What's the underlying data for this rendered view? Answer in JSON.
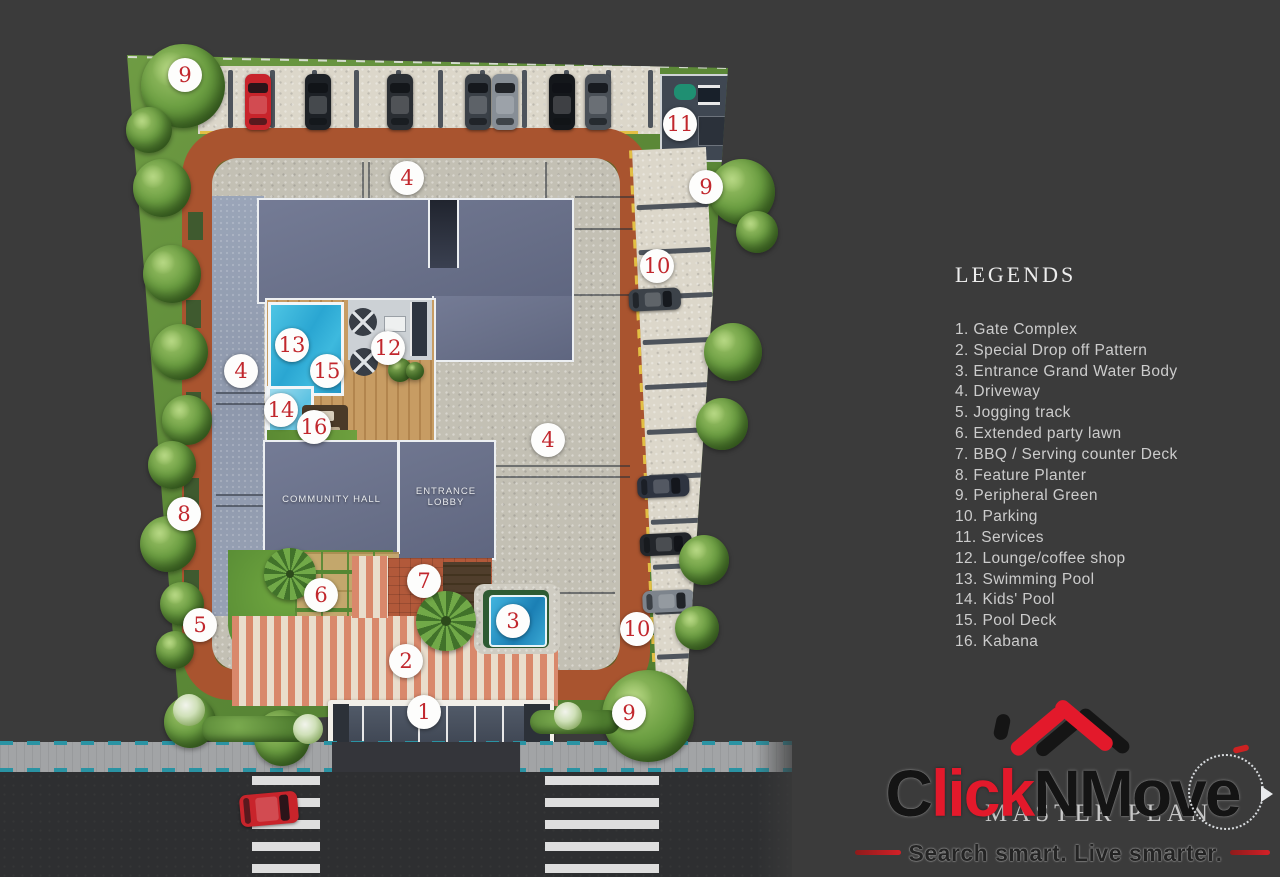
{
  "legend": {
    "title": "LEGENDS",
    "items": [
      "1. Gate Complex",
      "2. Special Drop off Pattern",
      "3. Entrance Grand Water Body",
      "4. Driveway",
      "5. Jogging track",
      "6. Extended party lawn",
      "7. BBQ / Serving counter Deck",
      "8. Feature Planter",
      "9. Peripheral Green",
      "10. Parking",
      "11. Services",
      "12. Lounge/coffee shop",
      "13. Swimming Pool",
      "14. Kids' Pool",
      "15.  Pool Deck",
      "16. Kabana"
    ]
  },
  "plan": {
    "building_labels": {
      "community_hall": "COMMUNITY HALL",
      "entrance_lobby_line1": "ENTRANCE",
      "entrance_lobby_line2": "LOBBY"
    },
    "markers": [
      {
        "n": "9",
        "x": 185,
        "y": 75
      },
      {
        "n": "4",
        "x": 407,
        "y": 178
      },
      {
        "n": "11",
        "x": 680,
        "y": 124
      },
      {
        "n": "9",
        "x": 706,
        "y": 187
      },
      {
        "n": "10",
        "x": 657,
        "y": 266
      },
      {
        "n": "13",
        "x": 292,
        "y": 345
      },
      {
        "n": "12",
        "x": 388,
        "y": 348
      },
      {
        "n": "15",
        "x": 327,
        "y": 371
      },
      {
        "n": "4",
        "x": 241,
        "y": 371
      },
      {
        "n": "14",
        "x": 281,
        "y": 410
      },
      {
        "n": "16",
        "x": 314,
        "y": 427
      },
      {
        "n": "4",
        "x": 548,
        "y": 440
      },
      {
        "n": "8",
        "x": 184,
        "y": 514
      },
      {
        "n": "7",
        "x": 424,
        "y": 581
      },
      {
        "n": "6",
        "x": 321,
        "y": 595
      },
      {
        "n": "3",
        "x": 513,
        "y": 621
      },
      {
        "n": "5",
        "x": 200,
        "y": 625
      },
      {
        "n": "10",
        "x": 637,
        "y": 629
      },
      {
        "n": "2",
        "x": 406,
        "y": 661
      },
      {
        "n": "1",
        "x": 424,
        "y": 712
      },
      {
        "n": "9",
        "x": 629,
        "y": 713
      }
    ],
    "cars_top_row": [
      {
        "x": 258,
        "color": "#c8242b"
      },
      {
        "x": 318,
        "color": "#1d2126"
      },
      {
        "x": 400,
        "color": "#2a2e33"
      },
      {
        "x": 478,
        "color": "#3a4047"
      },
      {
        "x": 505,
        "color": "#878e96"
      },
      {
        "x": 562,
        "color": "#14171b"
      },
      {
        "x": 598,
        "color": "#4a5057"
      }
    ],
    "cars_right_column": [
      {
        "y": 300,
        "color": "#3c4249"
      },
      {
        "y": 487,
        "color": "#2e3440"
      },
      {
        "y": 545,
        "color": "#23262b"
      },
      {
        "y": 602,
        "color": "#7d848c"
      }
    ],
    "road_car_color": "#c8242b",
    "trees": [
      [
        183,
        86,
        84
      ],
      [
        149,
        130,
        46
      ],
      [
        162,
        188,
        58
      ],
      [
        172,
        274,
        58
      ],
      [
        180,
        352,
        56
      ],
      [
        187,
        420,
        50
      ],
      [
        172,
        465,
        48
      ],
      [
        168,
        544,
        56
      ],
      [
        182,
        604,
        44
      ],
      [
        175,
        650,
        38
      ],
      [
        742,
        192,
        66
      ],
      [
        757,
        232,
        42
      ],
      [
        733,
        352,
        58
      ],
      [
        722,
        424,
        52
      ],
      [
        704,
        560,
        50
      ],
      [
        697,
        628,
        44
      ],
      [
        190,
        722,
        52
      ],
      [
        282,
        738,
        56
      ],
      [
        648,
        716,
        92
      ]
    ],
    "palms": [
      [
        290,
        574,
        52
      ],
      [
        446,
        621,
        60
      ]
    ],
    "hedges": [
      [
        262,
        729,
        120,
        26
      ],
      [
        575,
        722,
        90,
        24
      ]
    ],
    "flowers": [
      [
        189,
        710,
        16
      ],
      [
        308,
        729,
        15
      ],
      [
        568,
        716,
        14
      ]
    ]
  },
  "logo": {
    "seg_c": "C",
    "seg_lick": "lick",
    "seg_nmov": "NMov",
    "seg_e": "e",
    "tagline": "Search smart. Live smarter.",
    "watermark": "MASTER PLAN"
  },
  "colors": {
    "background": "#3b3b3b",
    "marker_red": "#c1272d",
    "logo_red": "#e3192b",
    "brick_track": "#a9542f",
    "pool_blue": "#2fb3dc",
    "grass_green": "#699f3e",
    "tagline_red": "#d32027"
  }
}
